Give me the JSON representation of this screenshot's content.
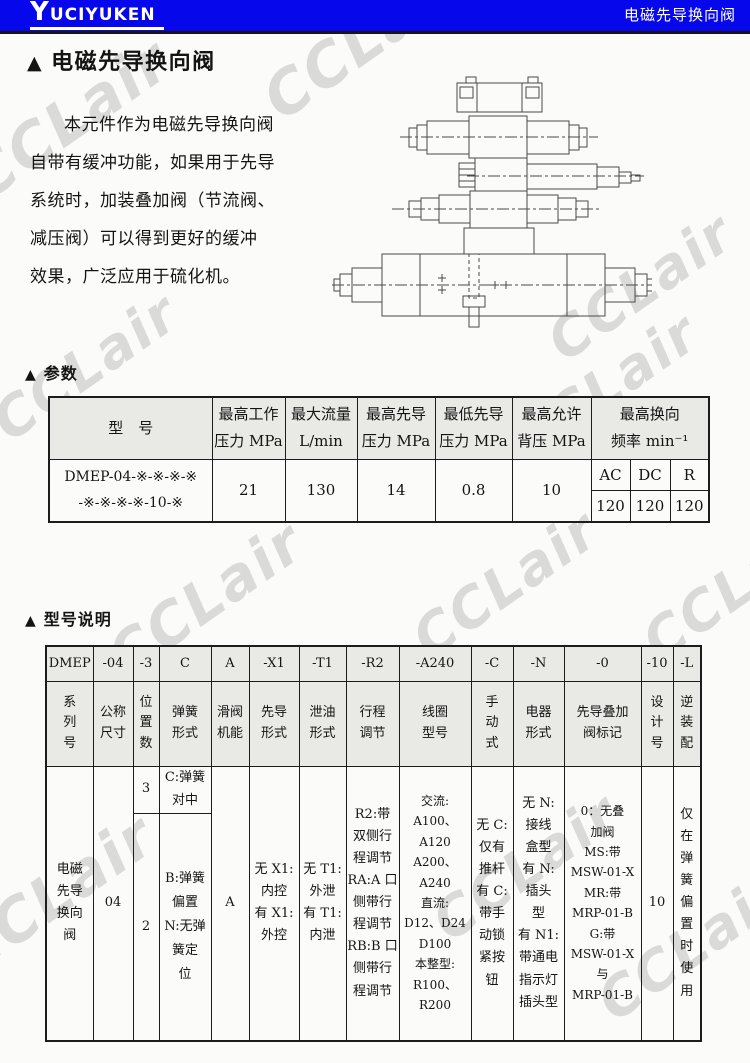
{
  "icons": {
    "section_marker": "▲"
  },
  "watermark": {
    "text": "CCLair"
  },
  "header": {
    "logo_text": "YUCIYUKEN",
    "product_title": "电磁先导换向阀"
  },
  "page": {
    "title": "电磁先导换向阀",
    "intro": "本元件作为电磁先导换向阀\n自带有缓冲功能，如果用于先导\n系统时，加装叠加阀（节流阀、\n减压阀）可以得到更好的缓冲\n效果，广泛应用于硫化机。",
    "section_params_label": "参数",
    "section_model_label": "型号说明"
  },
  "params_table": {
    "headers": {
      "model": "型　号",
      "max_working_pressure": "最高工作\n压力 MPa",
      "max_flow": "最大流量\nL/min",
      "max_pilot_pressure": "最高先导\n压力 MPa",
      "min_pilot_pressure": "最低先导\n压力 MPa",
      "max_back_pressure": "最高允许\n背压 MPa",
      "max_switch_freq": "最高换向\n频率 min⁻¹"
    },
    "row": {
      "model": "DMEP-04-※-※-※-※\n-※-※-※-※-10-※",
      "max_working_pressure": "21",
      "max_flow": "130",
      "max_pilot_pressure": "14",
      "min_pilot_pressure": "0.8",
      "max_back_pressure": "10",
      "freq_types": [
        "AC",
        "DC",
        "R"
      ],
      "freq_values": [
        "120",
        "120",
        "120"
      ]
    }
  },
  "model_table": {
    "codes": [
      "DMEP",
      "-04",
      "-3",
      "C",
      "A",
      "-X1",
      "-T1",
      "-R2",
      "-A240",
      "-C",
      "-N",
      "-0",
      "-10",
      "-L"
    ],
    "labels": [
      "系\n列\n号",
      "公称\n尺寸",
      "位\n置\n数",
      "弹簧\n形式",
      "滑阀\n机能",
      "先导\n形式",
      "泄油\n形式",
      "行程\n调节",
      "线圈\n型号",
      "手\n动\n式",
      "电器\n形式",
      "先导叠加\n阀标记",
      "设\n计\n号",
      "逆\n装\n配"
    ],
    "body": {
      "series": "电磁\n先导\n换向\n阀",
      "size": "04",
      "positions_top": "3",
      "positions_bottom": "2",
      "spring_top": "C:弹簧\n对中",
      "spring_bottom": "B:弹簧\n偏置\nN:无弹\n簧定\n位",
      "spool_function": "A",
      "pilot_type": "无 X1:\n内控\n有 X1:\n外控",
      "drain_type": "无 T1:\n外泄\n有 T1:\n内泄",
      "stroke_adjust": "R2:带\n双侧行\n程调节\nRA:A 口\n侧带行\n程调节\nRB:B 口\n侧带行\n程调节",
      "coil_model": "交流:\nA100、A120\nA200、A240\n直流:\nD12、D24\nD100\n本整型:\nR100、R200",
      "manual_type": "无 C:\n仅有\n推杆\n有 C:\n带手\n动锁\n紧按\n钮",
      "electrical_type": "无 N:\n接线\n盒型\n有 N:\n插头\n型\n有 N1:\n带通电\n指示灯\n插头型",
      "stack_valve_mark": "0：无叠\n加阀\nMS:带\nMSW-01-X\nMR:带\nMRP-01-B\nG:带\nMSW-01-X 与\nMRP-01-B",
      "design_no": "10",
      "reverse_assembly": "仅\n在\n弹\n簧\n偏\n置\n时\n使\n用"
    }
  }
}
